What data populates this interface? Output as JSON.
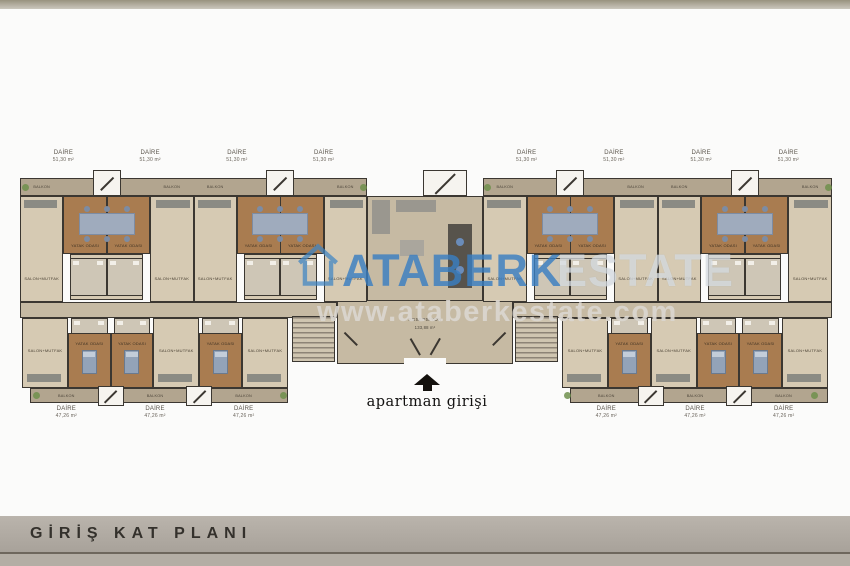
{
  "page": {
    "title": "GİRİŞ KAT PLANI"
  },
  "watermark": {
    "brand_primary": "ATABERK",
    "brand_secondary": "ESTATE",
    "website": "www.ataberkestate.com",
    "brand_color": "#3f85c4"
  },
  "plan": {
    "entrance_label": "apartman girişi",
    "reception": {
      "name": "RESEPSİYON",
      "area": "133,88 m²"
    },
    "unit_top": {
      "name": "DAİRE",
      "area": "51,30 m²",
      "count": 8
    },
    "unit_bottom": {
      "name": "DAİRE",
      "area": "47,26 m²",
      "count": 6
    },
    "rooms": {
      "bedroom": "YATAK ODASI",
      "living_kitchen": "SALON+MUTFAK",
      "balcony": "BALKON"
    },
    "colors": {
      "floor": "#d6cab3",
      "bedroom_floor": "#a97c50",
      "balcony_floor": "#b2a58f",
      "corridor_floor": "#c6baa3",
      "bath_floor": "#cec6b6",
      "wall": "#3b3731",
      "bed": "#93a3b8",
      "plant": "#6f8f4c",
      "counter": "#57534c",
      "stairs": "#cfc5b0"
    }
  }
}
